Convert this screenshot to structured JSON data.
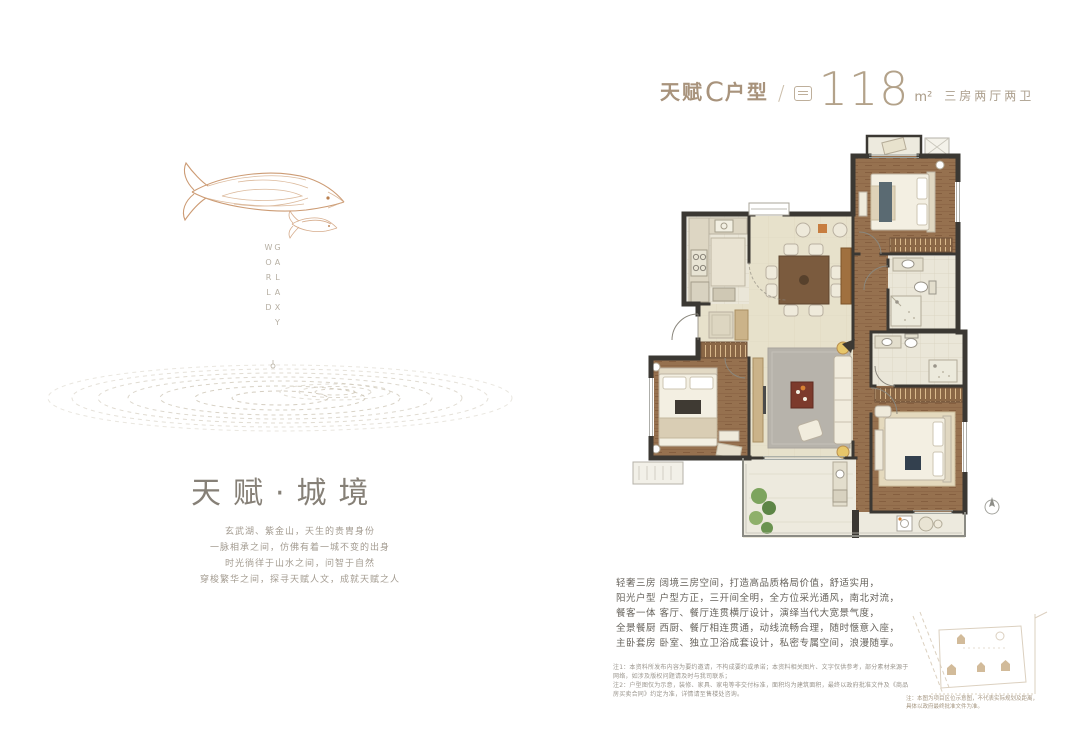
{
  "page": {
    "background": "#ffffff"
  },
  "header": {
    "type_prefix": "天赋",
    "type_variant": "C",
    "type_suffix": "户型",
    "separator": "/",
    "area_value": "118",
    "area_unit": "m²",
    "rooms_label": "三房两厅两卫"
  },
  "hero": {
    "vertical_text": "GALAXY WORLD"
  },
  "left_section": {
    "title": "天赋·城境",
    "paragraph": [
      "玄武湖、紫金山，天生的贵胄身份",
      "一脉相承之间，仿佛有着一城不变的出身",
      "时光徜徉于山水之间，问智于自然",
      "穿梭繁华之间，探寻天赋人文，成就天赋之人"
    ]
  },
  "description": {
    "lines": [
      "轻奢三房 阔境三房空间，打造高品质格局价值，舒适实用，",
      "阳光户型 户型方正，三开间全明，全方位采光通风，南北对流，",
      "餐客一体 客厅、餐厅连贯横厅设计，演绎当代大宽景气度，",
      "全景餐厨 西厨、餐厅相连贯通，动线流畅合理，随时惬意入座，",
      "主卧套房 卧室、独立卫浴成套设计，私密专属空间，浪漫随享。"
    ]
  },
  "disclaimer": {
    "lines": [
      "注1：本资料所发布内容为要约邀请，不构成要约或承诺；本资料相关图片、文字仅供参考，部分素材来源于网络，如涉及版权问题请及时与我司联系；",
      "注2：户型图仅为示意，装修、家具、家电等非交付标准，面积均为建筑面积，最终以政府批准文件及《商品房买卖合同》约定为准，详情请至售楼处咨询。"
    ]
  },
  "site_sketch": {
    "caption": [
      "注：本图为项目区位示意图，不代表实际规划及距离，",
      "具体以政府最终批准文件为准。"
    ]
  },
  "icons": {
    "area_badge": "area-badge-icon",
    "compass": "north-compass-icon"
  },
  "colors": {
    "brand_bronze": "#a8937c",
    "number_tan": "#b3a28a",
    "title_gray": "#868077",
    "fish_copper": "#c48a5c",
    "ripple": "#cfc8b9",
    "wall_dark": "#3b3833",
    "wood_floor": "#926d4c",
    "marble_floor": "#e8e2cc",
    "rug_gray": "#b7b3ab",
    "accent_red": "#7c3a2c",
    "plant_green": "#7da45e"
  }
}
